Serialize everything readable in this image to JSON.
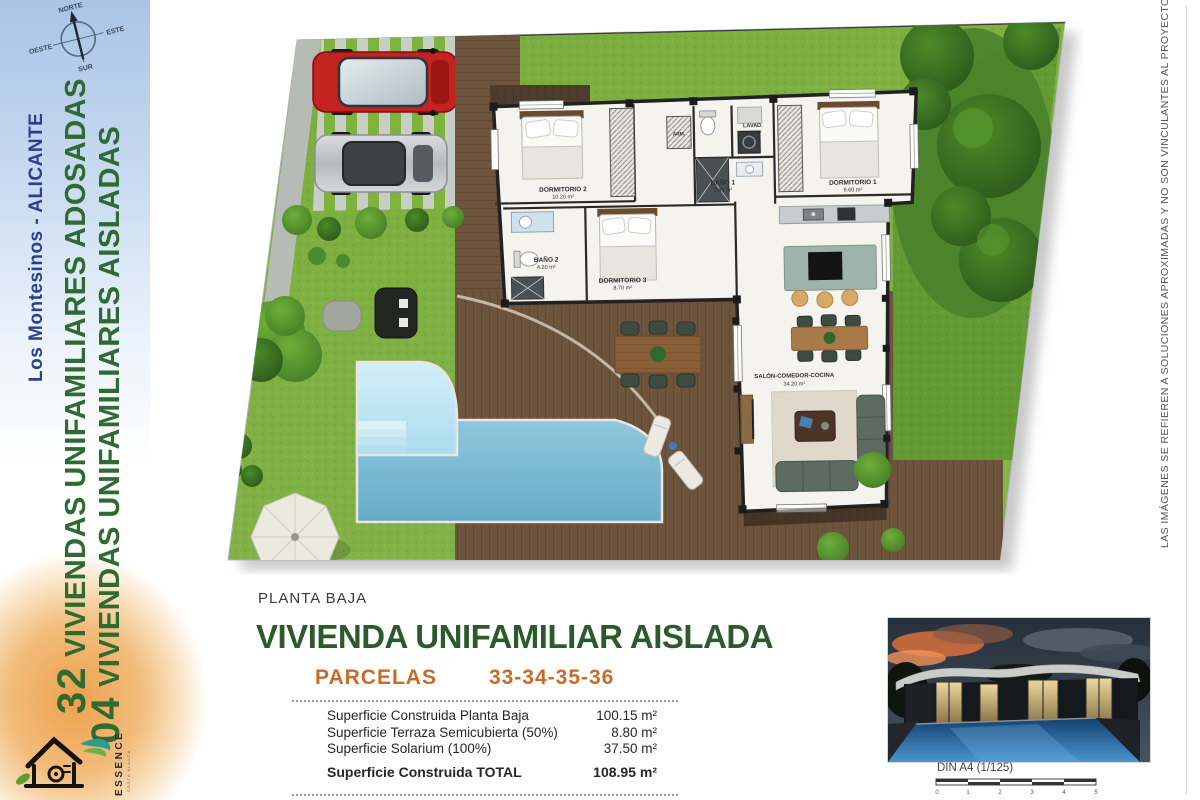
{
  "document": {
    "floor_label": "PLANTA BAJA",
    "title": "VIVIENDA UNIFAMILIAR AISLADA",
    "parcels_label": "PARCELAS",
    "parcels_numbers": "33-34-35-36"
  },
  "sidebar": {
    "compass": {
      "north": "NORTE",
      "south": "SUR",
      "east": "ESTE",
      "west": "OESTE"
    },
    "location": "Los Montesinos - ALICANTE",
    "project_lines": [
      {
        "number": "32",
        "text": " VIVIENDAS UNIFAMILIARES ADOSADAS"
      },
      {
        "number": "04",
        "text": " VIVIENDAS UNIFAMILIARES AISLADAS"
      }
    ],
    "logo": {
      "brand": "ESSENCE",
      "tagline": "COSTA BLANCA"
    }
  },
  "plan": {
    "rooms": [
      {
        "name": "DORMITORIO 2",
        "area": "10.20 m²"
      },
      {
        "name": "BAÑO 1",
        "area": "3.80 m²"
      },
      {
        "name": "LAVAD.",
        "area": "2.00 m²"
      },
      {
        "name": "DORMITORIO 1",
        "area": "9.60 m²"
      },
      {
        "name": "BAÑO 2",
        "area": "4.20 m²"
      },
      {
        "name": "DORMITORIO 3",
        "area": "8.70 m²"
      },
      {
        "name": "SALÓN-COMEDOR-COCINA",
        "area": "34.20 m²"
      },
      {
        "name": "ARM.",
        "area": ""
      }
    ]
  },
  "surface_table": {
    "rows": [
      {
        "label": "Superficie Construida Planta Baja",
        "value": "100.15 m²"
      },
      {
        "label": "Superficie Terraza Semicubierta (50%)",
        "value": "8.80 m²"
      },
      {
        "label": "Superficie Solarium (100%)",
        "value": "37.50 m²"
      }
    ],
    "total": {
      "label": "Superficie Construida TOTAL",
      "value": "108.95 m²"
    }
  },
  "scale_bar": {
    "label": "DIN A4 (1/125)",
    "ticks": [
      "0",
      "1",
      "2",
      "3",
      "4",
      "5"
    ]
  },
  "disclaimer": "LAS IMÁGENES SE REFIEREN A SOLUCIONES APROXIMADAS Y NO SON VINCULANTES AL PROYECTO FINAL",
  "colors": {
    "title_green": "#2d5a2b",
    "accent_orange": "#c96a28",
    "lawn_green": "#7cae3f",
    "deck_brown": "#6d543d",
    "pool_blue": "#7fc0d9",
    "sidebar_blue": "#aec7e8",
    "glow_orange": "#eda04c"
  }
}
